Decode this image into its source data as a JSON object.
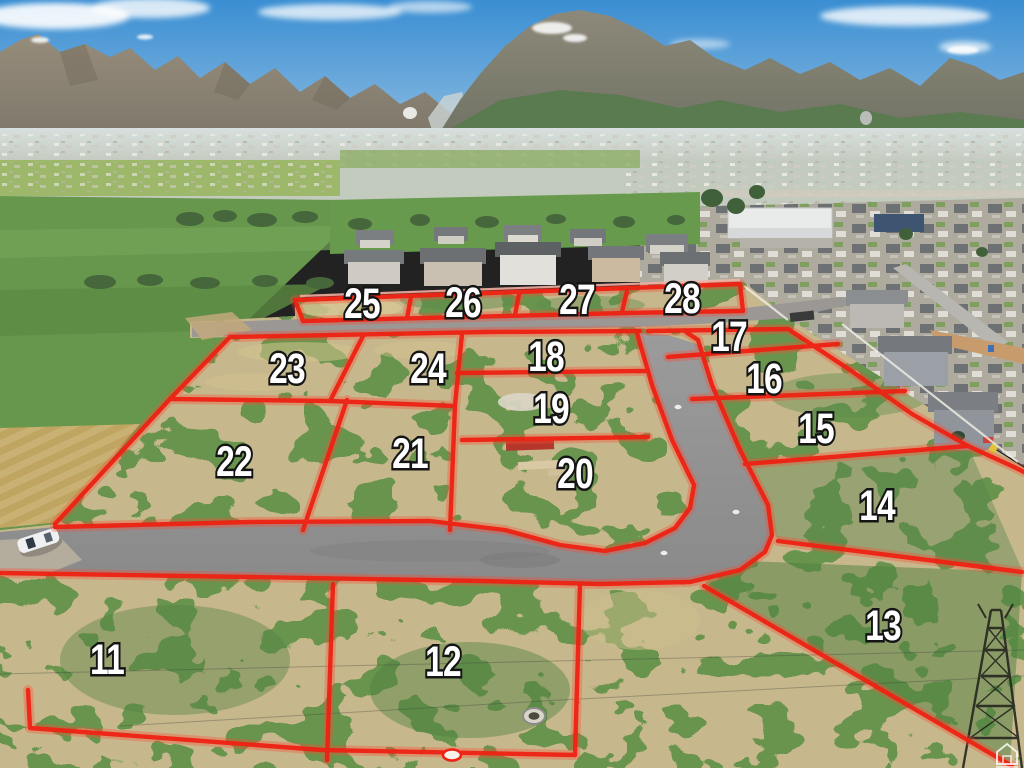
{
  "scene": {
    "kind": "aerial-subdivision-lot-photo",
    "colors": {
      "lot_line": "#ee2213",
      "lot_label_fill": "#ffffff",
      "lot_label_outline": "#151515",
      "sky_top": "#3a8ed2",
      "sky_horizon": "#a9cce6"
    }
  },
  "lots": [
    {
      "number": "11",
      "x": 107,
      "y": 659
    },
    {
      "number": "12",
      "x": 443,
      "y": 661
    },
    {
      "number": "13",
      "x": 883,
      "y": 625
    },
    {
      "number": "14",
      "x": 877,
      "y": 505
    },
    {
      "number": "15",
      "x": 816,
      "y": 428
    },
    {
      "number": "16",
      "x": 764,
      "y": 378
    },
    {
      "number": "17",
      "x": 729,
      "y": 336
    },
    {
      "number": "18",
      "x": 546,
      "y": 356
    },
    {
      "number": "19",
      "x": 551,
      "y": 408
    },
    {
      "number": "20",
      "x": 575,
      "y": 473
    },
    {
      "number": "21",
      "x": 410,
      "y": 453
    },
    {
      "number": "22",
      "x": 234,
      "y": 461
    },
    {
      "number": "23",
      "x": 287,
      "y": 368
    },
    {
      "number": "24",
      "x": 428,
      "y": 368
    },
    {
      "number": "25",
      "x": 362,
      "y": 303
    },
    {
      "number": "26",
      "x": 463,
      "y": 302
    },
    {
      "number": "27",
      "x": 577,
      "y": 299
    },
    {
      "number": "28",
      "x": 682,
      "y": 298
    }
  ],
  "watermark": {
    "icon": "house-icon"
  }
}
